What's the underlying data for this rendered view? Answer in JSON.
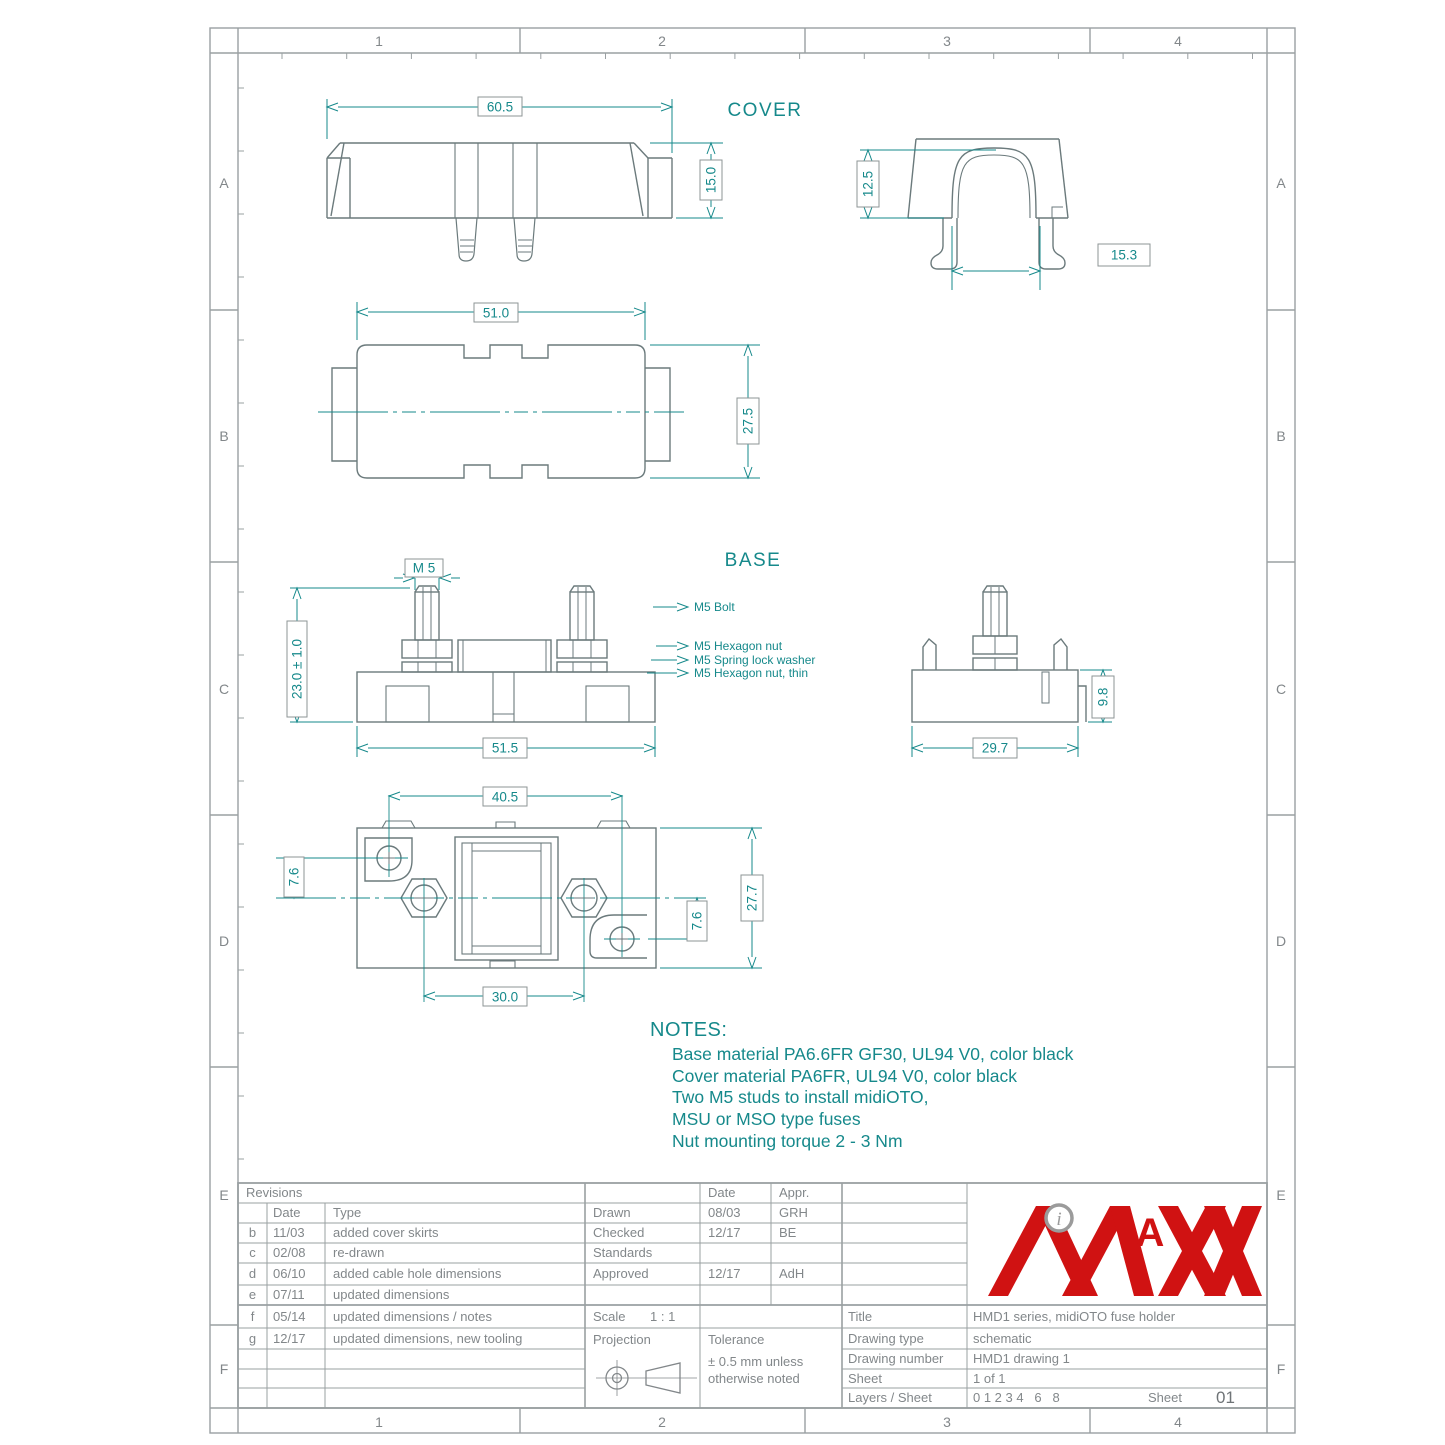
{
  "frame": {
    "columns": [
      "1",
      "2",
      "3",
      "4"
    ],
    "rows": [
      "A",
      "B",
      "C",
      "D",
      "E",
      "F"
    ]
  },
  "views": {
    "cover_label": "COVER",
    "base_label": "BASE"
  },
  "dimensions": {
    "cover_front_width": "60.5",
    "cover_front_height": "15.0",
    "cover_side_depth": "12.5",
    "cover_side_leg_span": "15.3",
    "cover_top_length": "51.0",
    "cover_top_width": "27.5",
    "base_stud_thread": "M 5",
    "base_height": "23.0 ± 1.0",
    "base_length": "51.5",
    "base_side_width": "29.7",
    "base_side_height": "9.8",
    "base_top_hole_span": "40.5",
    "base_top_hole_offset_left": "7.6",
    "base_top_hole_offset_right": "7.6",
    "base_top_width": "27.7",
    "base_top_stud_span": "30.0"
  },
  "callouts": {
    "bolt": "M5 Bolt",
    "hex_nut": "M5 Hexagon nut",
    "spring_washer": "M5 Spring lock washer",
    "hex_nut_thin": "M5 Hexagon nut, thin"
  },
  "notes": {
    "title": "NOTES:",
    "lines": [
      "Base material PA6.6FR GF30, UL94 V0, color black",
      "Cover material PA6FR, UL94 V0, color black",
      "Two M5 studs to install midiOTO,",
      "MSU or MSO type fuses",
      "Nut mounting torque 2 - 3 Nm"
    ]
  },
  "title_block": {
    "revisions": {
      "title": "Revisions",
      "date_header": "Date",
      "type_header": "Type",
      "rows": [
        {
          "id": "b",
          "date": "11/03",
          "type": "added cover skirts"
        },
        {
          "id": "c",
          "date": "02/08",
          "type": "re-drawn"
        },
        {
          "id": "d",
          "date": "06/10",
          "type": "added cable hole dimensions"
        },
        {
          "id": "e",
          "date": "07/11",
          "type": "updated dimensions"
        },
        {
          "id": "f",
          "date": "05/14",
          "type": "updated dimensions / notes"
        },
        {
          "id": "g",
          "date": "12/17",
          "type": "updated dimensions, new tooling"
        }
      ]
    },
    "approvals": {
      "date_header": "Date",
      "appr_header": "Appr.",
      "rows": [
        {
          "label": "Drawn",
          "date": "08/03",
          "appr": "GRH"
        },
        {
          "label": "Checked",
          "date": "12/17",
          "appr": "BE"
        },
        {
          "label": "Standards",
          "date": "",
          "appr": ""
        },
        {
          "label": "Approved",
          "date": "12/17",
          "appr": "AdH"
        }
      ]
    },
    "scale_label": "Scale",
    "scale_value": "1 : 1",
    "projection_label": "Projection",
    "tolerance_label": "Tolerance",
    "tolerance_line1": "± 0.5 mm unless",
    "tolerance_line2": "otherwise noted",
    "info": {
      "title_label": "Title",
      "title_value": "HMD1 series, midiOTO fuse holder",
      "type_label": "Drawing type",
      "type_value": "schematic",
      "number_label": "Drawing number",
      "number_value": "HMD1 drawing 1",
      "sheet_label": "Sheet",
      "sheet_value": "1 of 1",
      "layers_label": "Layers / Sheet",
      "layers_value": "0 1 2 3 4   6   8",
      "sheet_corner_label": "Sheet",
      "sheet_corner_value": "01"
    },
    "logo": {
      "circle_letter": "i",
      "a_letter": "A",
      "text": "MAXX"
    }
  },
  "colors": {
    "teal": "#16898b",
    "part_line": "#6b7a7c",
    "frame_line": "#9aa0a2",
    "text_gray": "#82878a",
    "logo_red": "#d01212"
  }
}
